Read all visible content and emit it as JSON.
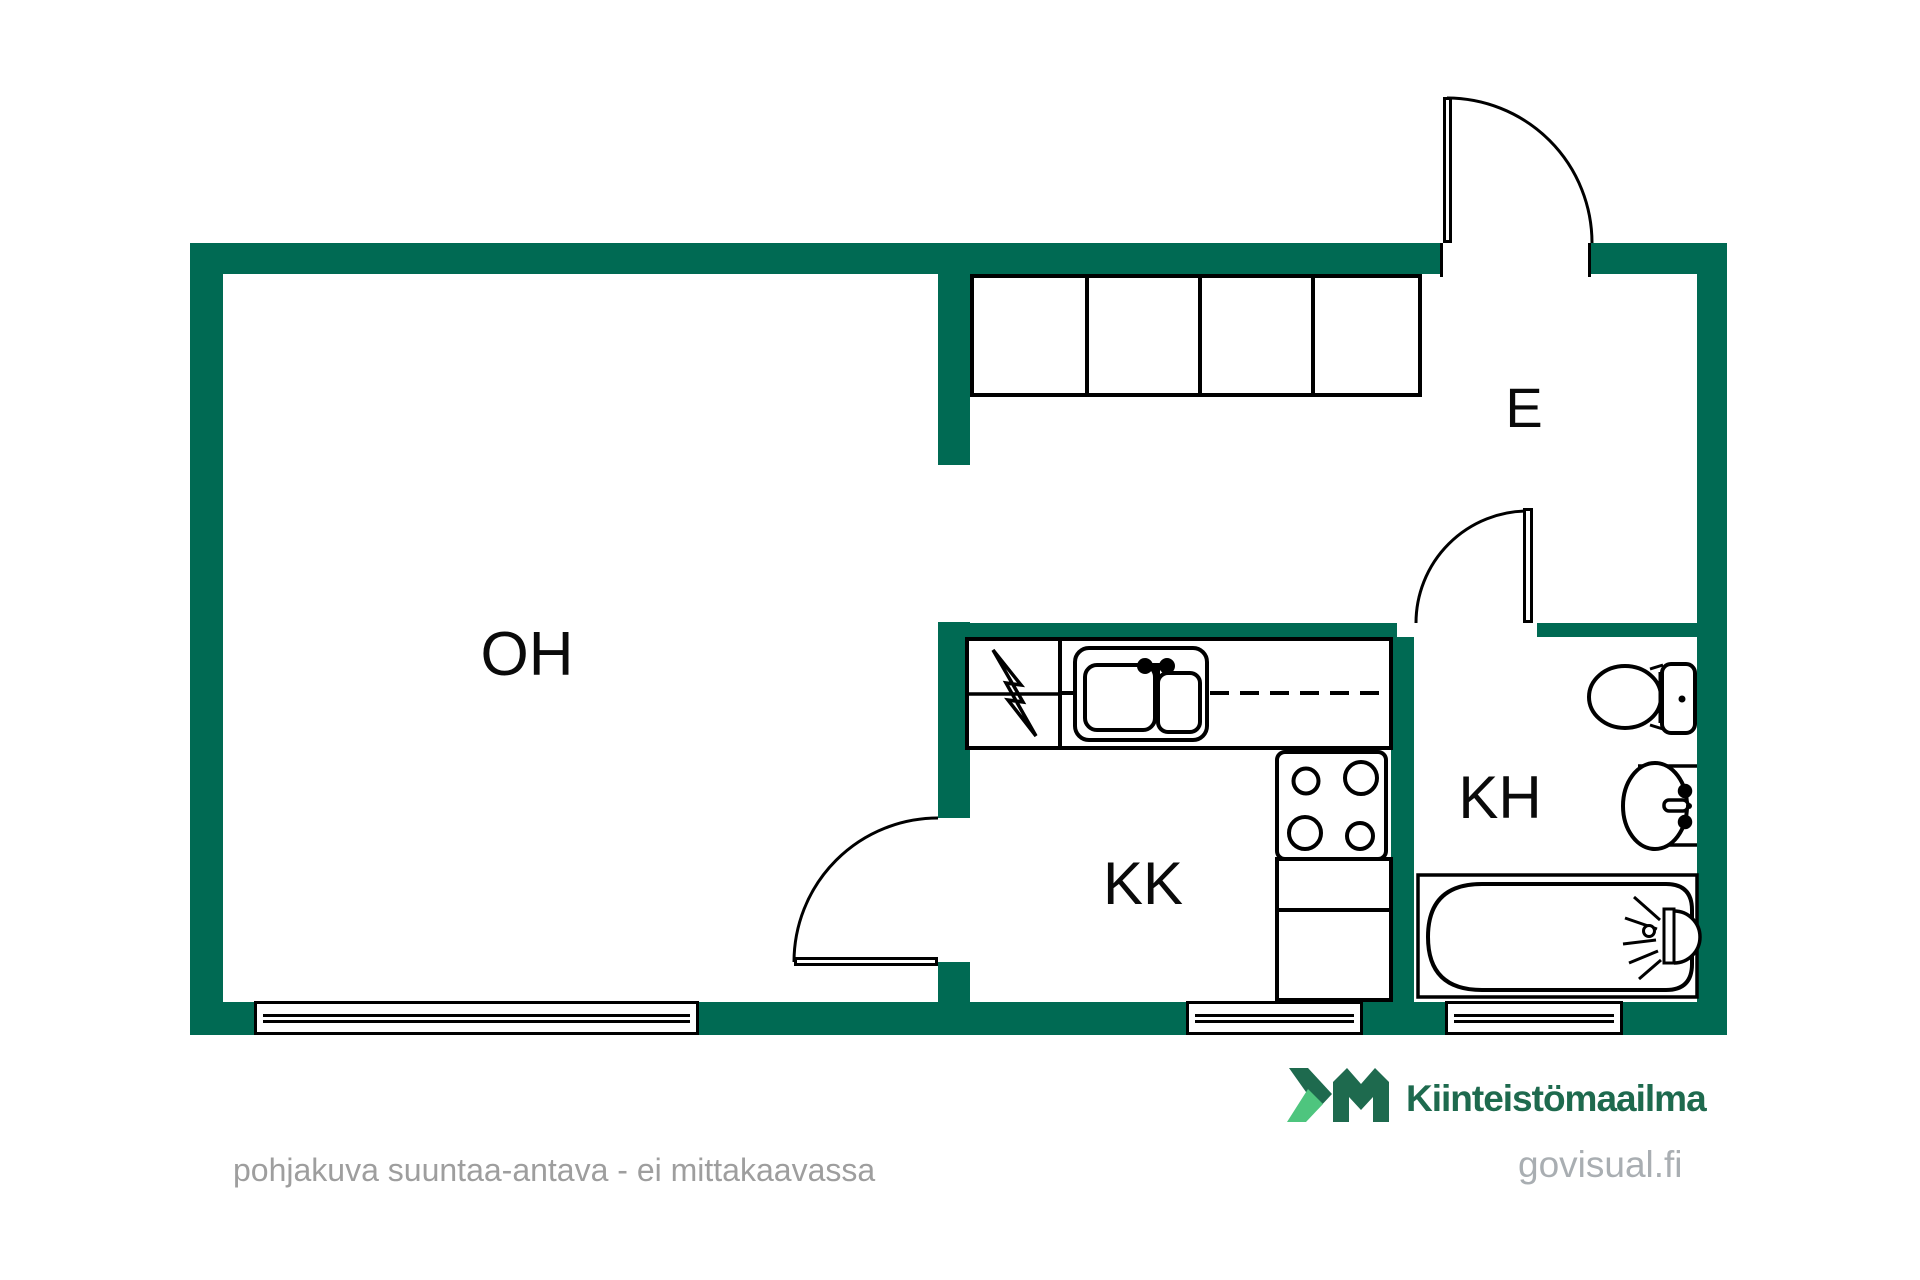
{
  "colors": {
    "wall": "#006a53",
    "line": "#000000",
    "logo_dark": "#1e6a4e",
    "logo_light": "#4ec57e",
    "footer_gray": "#9e9e9e",
    "watermark_gray": "#a9aeb2"
  },
  "rooms": [
    {
      "id": "oh",
      "label": "OH"
    },
    {
      "id": "kk",
      "label": "KK"
    },
    {
      "id": "kh",
      "label": "KH"
    },
    {
      "id": "e",
      "label": "E"
    }
  ],
  "fixtures": [
    "wardrobe-closets",
    "kitchen-sink",
    "stove",
    "electrical-symbol",
    "toilet",
    "bathroom-sink",
    "bathtub",
    "shower-mixer",
    "entrance-door",
    "bathroom-door",
    "kitchen-door",
    "window-oh",
    "window-kk",
    "window-kh"
  ],
  "footer": {
    "disclaimer": "pohjakuva suuntaa-antava - ei mittakaavassa",
    "brand_mark": "KM",
    "brand": "Kiinteistömaailma",
    "watermark": "govisual.fi"
  }
}
